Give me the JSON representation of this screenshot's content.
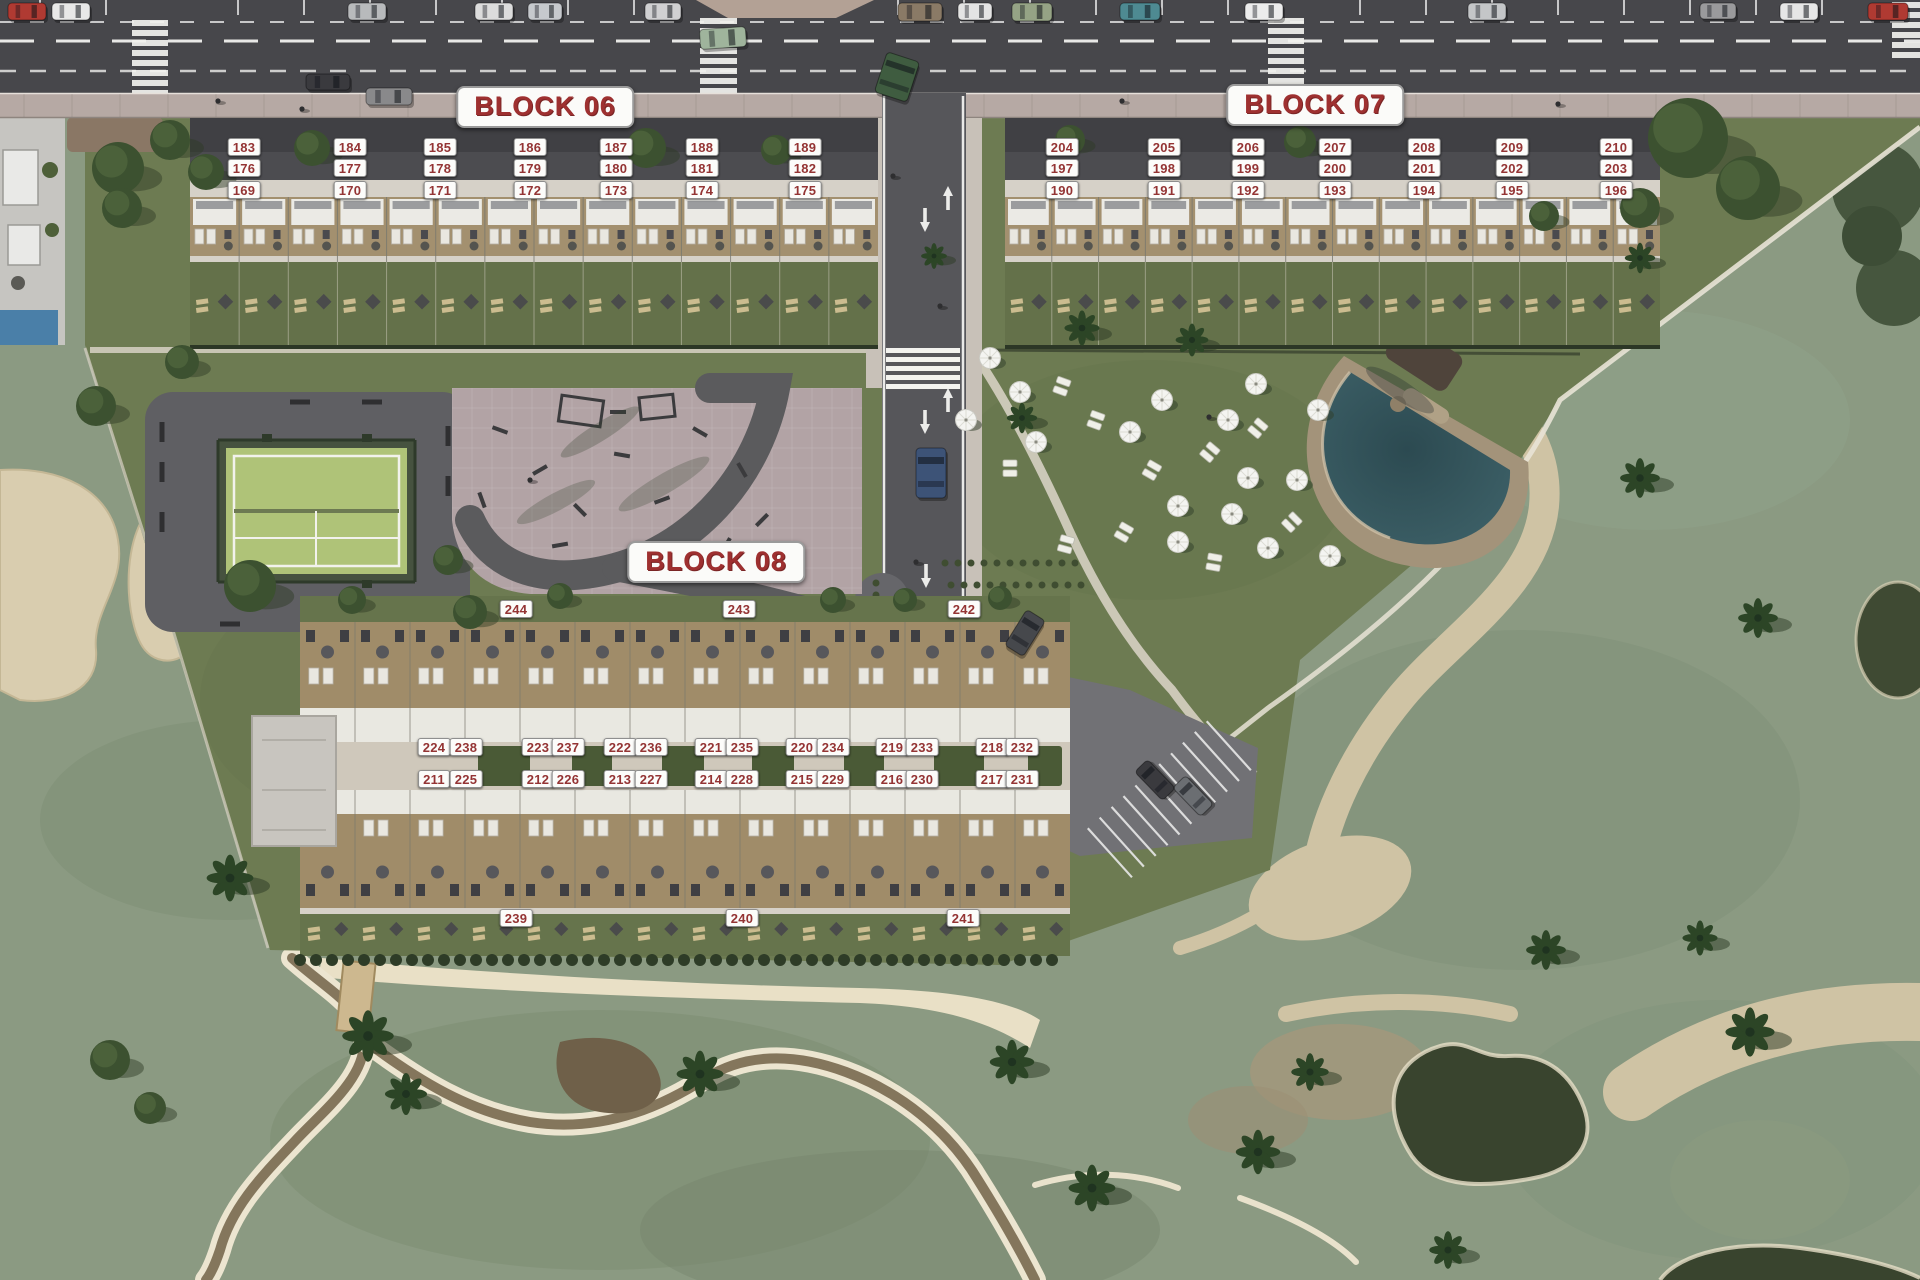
{
  "app": {
    "type": "residential-masterplan-siteplan"
  },
  "blocks": [
    {
      "id": "block-06",
      "title": "BLOCK 06",
      "title_x": 545,
      "title_y": 107,
      "units": [
        [
          183,
          244,
          147
        ],
        [
          184,
          350,
          147
        ],
        [
          185,
          440,
          147
        ],
        [
          186,
          530,
          147
        ],
        [
          187,
          616,
          147
        ],
        [
          188,
          702,
          147
        ],
        [
          189,
          805,
          147
        ],
        [
          176,
          244,
          168
        ],
        [
          177,
          350,
          168
        ],
        [
          178,
          440,
          168
        ],
        [
          179,
          530,
          168
        ],
        [
          180,
          616,
          168
        ],
        [
          181,
          702,
          168
        ],
        [
          182,
          805,
          168
        ],
        [
          169,
          244,
          190
        ],
        [
          170,
          350,
          190
        ],
        [
          171,
          440,
          190
        ],
        [
          172,
          530,
          190
        ],
        [
          173,
          616,
          190
        ],
        [
          174,
          702,
          190
        ],
        [
          175,
          805,
          190
        ]
      ]
    },
    {
      "id": "block-07",
      "title": "BLOCK 07",
      "title_x": 1315,
      "title_y": 105,
      "units": [
        [
          204,
          1062,
          147
        ],
        [
          205,
          1164,
          147
        ],
        [
          206,
          1248,
          147
        ],
        [
          207,
          1335,
          147
        ],
        [
          208,
          1424,
          147
        ],
        [
          209,
          1512,
          147
        ],
        [
          210,
          1616,
          147
        ],
        [
          197,
          1062,
          168
        ],
        [
          198,
          1164,
          168
        ],
        [
          199,
          1248,
          168
        ],
        [
          200,
          1335,
          168
        ],
        [
          201,
          1424,
          168
        ],
        [
          202,
          1512,
          168
        ],
        [
          203,
          1616,
          168
        ],
        [
          190,
          1062,
          190
        ],
        [
          191,
          1164,
          190
        ],
        [
          192,
          1248,
          190
        ],
        [
          193,
          1335,
          190
        ],
        [
          194,
          1424,
          190
        ],
        [
          195,
          1512,
          190
        ],
        [
          196,
          1616,
          190
        ]
      ]
    },
    {
      "id": "block-08",
      "title": "BLOCK 08",
      "title_x": 716,
      "title_y": 562,
      "units": [
        [
          244,
          516,
          609
        ],
        [
          243,
          739,
          609
        ],
        [
          242,
          964,
          609
        ],
        [
          224,
          434,
          747
        ],
        [
          238,
          466,
          747
        ],
        [
          223,
          538,
          747
        ],
        [
          237,
          568,
          747
        ],
        [
          222,
          620,
          747
        ],
        [
          236,
          651,
          747
        ],
        [
          221,
          711,
          747
        ],
        [
          235,
          742,
          747
        ],
        [
          220,
          802,
          747
        ],
        [
          234,
          833,
          747
        ],
        [
          219,
          892,
          747
        ],
        [
          233,
          922,
          747
        ],
        [
          218,
          992,
          747
        ],
        [
          232,
          1022,
          747
        ],
        [
          211,
          434,
          779
        ],
        [
          225,
          466,
          779
        ],
        [
          212,
          538,
          779
        ],
        [
          226,
          568,
          779
        ],
        [
          213,
          620,
          779
        ],
        [
          227,
          651,
          779
        ],
        [
          214,
          711,
          779
        ],
        [
          228,
          742,
          779
        ],
        [
          215,
          802,
          779
        ],
        [
          229,
          833,
          779
        ],
        [
          216,
          892,
          779
        ],
        [
          230,
          922,
          779
        ],
        [
          217,
          992,
          779
        ],
        [
          231,
          1022,
          779
        ],
        [
          239,
          516,
          918
        ],
        [
          240,
          742,
          918
        ],
        [
          241,
          963,
          918
        ]
      ]
    }
  ],
  "colors": {
    "label_text": "#943434",
    "label_bg": "#fcfcfa",
    "title_text": "#9e3030",
    "site_green": "#6d7b52",
    "golf_green": "#8b9a82",
    "road_asphalt": "#47474b",
    "sidewalk": "#b6a9a4",
    "plaza_pink": "#b2a3a5",
    "padel_green": "#afc378",
    "pool_water": "#37575e",
    "pool_deck": "#a3937a",
    "sand": "#d9cdaf",
    "pond": "#39442e",
    "terrace_wood": "#a08c69",
    "roof_white": "#eae9e3"
  },
  "vehicles": [
    [
      8,
      3,
      38,
      17,
      "#b03a32",
      0
    ],
    [
      52,
      3,
      38,
      17,
      "#e8e8e8",
      0
    ],
    [
      348,
      3,
      38,
      17,
      "#b8babc",
      0
    ],
    [
      475,
      3,
      38,
      17,
      "#dcdcdc",
      0
    ],
    [
      528,
      3,
      34,
      17,
      "#c6c9cd",
      0
    ],
    [
      645,
      3,
      36,
      17,
      "#d0d0d2",
      0
    ],
    [
      898,
      3,
      44,
      18,
      "#8a7a66",
      0
    ],
    [
      958,
      3,
      34,
      17,
      "#e4e4e4",
      0
    ],
    [
      1012,
      3,
      40,
      18,
      "#95a385",
      0
    ],
    [
      1120,
      3,
      40,
      17,
      "#4e8a92",
      0
    ],
    [
      1245,
      3,
      38,
      17,
      "#ececec",
      0
    ],
    [
      1468,
      3,
      38,
      17,
      "#c4c6c8",
      0
    ],
    [
      1700,
      3,
      36,
      16,
      "#9a9a9c",
      0
    ],
    [
      1780,
      3,
      38,
      17,
      "#e6e6e6",
      0
    ],
    [
      1868,
      3,
      40,
      17,
      "#b03a32",
      0
    ],
    [
      306,
      74,
      44,
      16,
      "#3a3a3e",
      0
    ],
    [
      700,
      28,
      46,
      20,
      "#9fb49c",
      -4
    ],
    [
      880,
      56,
      34,
      42,
      "#3f5c40",
      18
    ],
    [
      366,
      88,
      46,
      17,
      "#89898b",
      0
    ],
    [
      916,
      448,
      30,
      50,
      "#3d5377",
      0
    ],
    [
      1014,
      612,
      22,
      42,
      "#46484c",
      32
    ],
    [
      1146,
      760,
      18,
      40,
      "#3a3a3e",
      -44
    ],
    [
      1184,
      776,
      18,
      40,
      "#6b6e72",
      -44
    ]
  ],
  "umbrellas": [
    [
      990,
      358
    ],
    [
      1020,
      392
    ],
    [
      966,
      420
    ],
    [
      1036,
      442
    ],
    [
      1162,
      400
    ],
    [
      1130,
      432
    ],
    [
      1256,
      384
    ],
    [
      1228,
      420
    ],
    [
      1248,
      478
    ],
    [
      1297,
      480
    ],
    [
      1178,
      506
    ],
    [
      1232,
      514
    ],
    [
      1178,
      542
    ],
    [
      1268,
      548
    ],
    [
      1318,
      410
    ],
    [
      1330,
      556
    ]
  ],
  "sunbeds": [
    [
      1062,
      386,
      20
    ],
    [
      1096,
      420,
      20
    ],
    [
      1210,
      452,
      40
    ],
    [
      1258,
      428,
      40
    ],
    [
      1152,
      470,
      30
    ],
    [
      1214,
      562,
      10
    ],
    [
      1124,
      532,
      30
    ],
    [
      1010,
      468,
      0
    ],
    [
      1292,
      522,
      45
    ],
    [
      1066,
      544,
      15
    ]
  ]
}
